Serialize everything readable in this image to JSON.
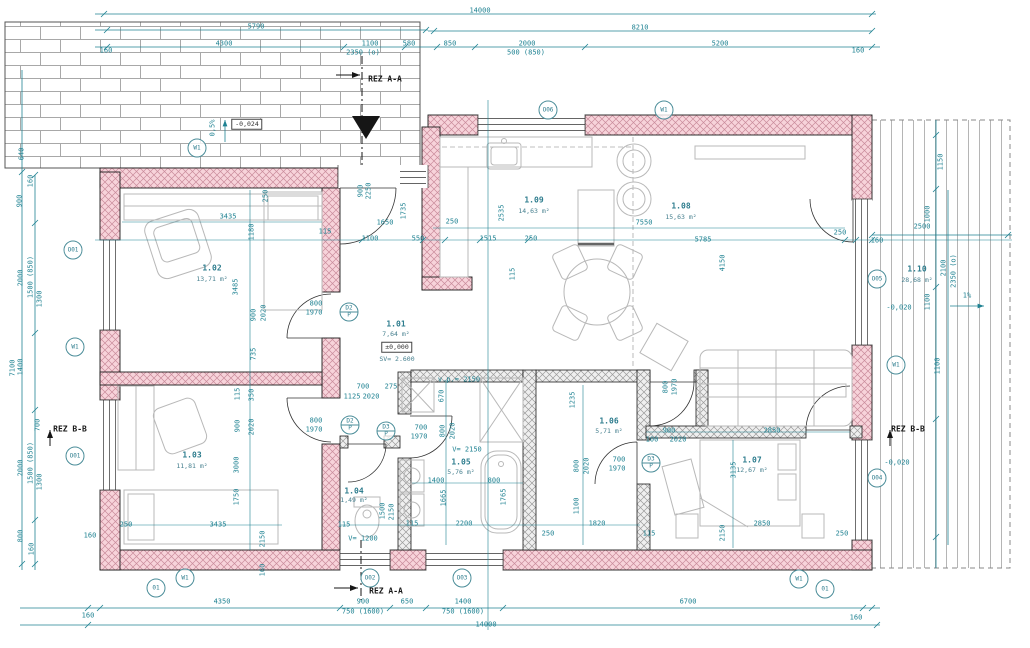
{
  "rooms": {
    "r101": {
      "no": "1.01",
      "area": "7,64 m²",
      "level": "±0,000",
      "height": "SV= 2.600"
    },
    "r102": {
      "no": "1.02",
      "area": "13,71 m²"
    },
    "r103": {
      "no": "1.03",
      "area": "11,81 m²"
    },
    "r104": {
      "no": "1.04",
      "area": "1,49 m²"
    },
    "r105": {
      "no": "1.05",
      "area": "5,76 m²"
    },
    "r106": {
      "no": "1.06",
      "area": "5,71 m²"
    },
    "r107": {
      "no": "1.07",
      "area": "12,67 m²"
    },
    "r108": {
      "no": "1.08",
      "area": "15,63 m²"
    },
    "r109": {
      "no": "1.09",
      "area": "14,63 m²"
    },
    "r110": {
      "no": "1.10",
      "area": "28,68 m²"
    }
  },
  "sections": {
    "aa": "REZ A-A",
    "bb": "REZ B-B"
  },
  "levels": {
    "paving": "-0,024",
    "terrace": "-0,020",
    "floor": "±0,000",
    "height": "SV= 2.600",
    "v2150": "V= 2150",
    "vp2150": "v.p.= 2150",
    "v1200": "V= 1200"
  },
  "slopes": {
    "paving": "0,5%",
    "terrace": "1%"
  },
  "symbols": {
    "w1": "W1",
    "o01": "O01",
    "o02": "O02",
    "o03": "O03",
    "o04": "O04",
    "o05": "O05",
    "o06": "O06",
    "o1": "01",
    "d2": "D2",
    "d3": "D3",
    "p": "P"
  },
  "dims": {
    "d14000": "14000",
    "d8210": "8210",
    "d5790": "5790",
    "d4300": "4300",
    "d1100": "1100",
    "d580": "580",
    "d2350o": "2350 (o)",
    "d160": "160",
    "d850": "850",
    "d2000": "2000",
    "d500_850": "500 (850)",
    "d5200": "5200",
    "d2500": "2500",
    "d1150": "1150",
    "d1000": "1000",
    "d2100": "2100",
    "d7100": "7100",
    "d900": "900",
    "d100": "100",
    "d1500_850": "1500 (850)",
    "d1300": "1300",
    "d1400": "1400",
    "d700": "700",
    "d800": "800",
    "d640": "640",
    "d4350": "4350",
    "d750_1600": "750 (1600)",
    "d650": "650",
    "d6700": "6700",
    "d3435": "3435",
    "d250": "250",
    "d1180": "1180",
    "d3485": "3485",
    "d2020": "2020",
    "d735": "735",
    "d115": "115",
    "d350": "350",
    "d3000": "3000",
    "d1750": "1750",
    "d2150": "2150",
    "d1650": "1650",
    "d550": "550",
    "d1735": "1735",
    "d1515": "1515",
    "d2535": "2535",
    "d7550": "7550",
    "d5785": "5785",
    "d4150": "4150",
    "d2850": "2850",
    "d3135": "3135",
    "d1235": "1235",
    "d1820": "1820",
    "d1665": "1665",
    "d2200": "2200",
    "d1765": "1765",
    "d670": "670",
    "d1125": "1125",
    "d275": "275",
    "d1970": "1970",
    "d2250": "2250",
    "d1500": "1500"
  }
}
